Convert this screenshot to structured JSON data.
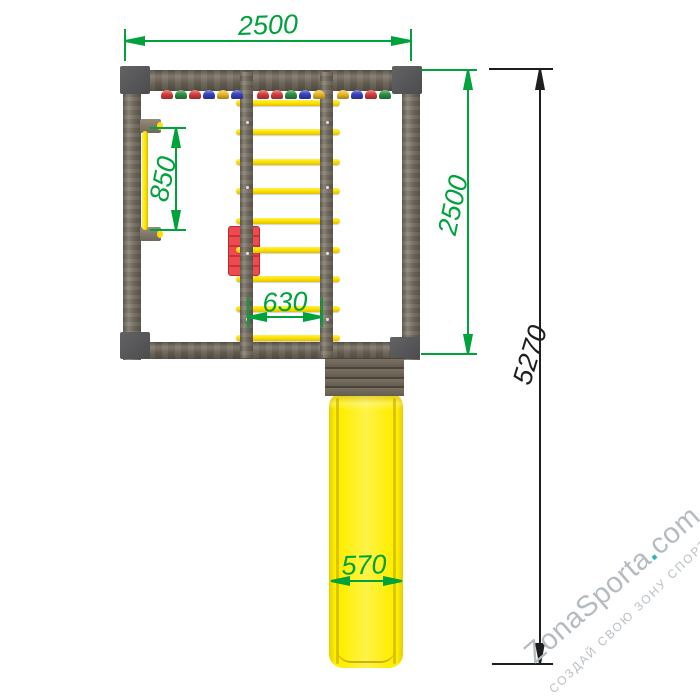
{
  "drawing": {
    "title_semantics": "playground-top-view-drawing",
    "dimensions": {
      "top_width": "2500",
      "right_height": "2500",
      "grab_bar_length": "850",
      "ladder_span": "630",
      "slide_width": "570",
      "total_length": "5270"
    },
    "colors": {
      "dimension_green": "#00a23c",
      "dimension_black": "#1e1e20",
      "wood_beam": "#7b7365",
      "corner_gray": "#58585b",
      "rung_yellow": "#ffe400",
      "slide_yellow": "#ffee00",
      "red_panel": "#e04045",
      "watermark_gray": "#b5bcc1",
      "watermark_teal": "#31b7ae"
    },
    "structure": {
      "rung_count": 9,
      "plank_count": 4,
      "holds_groups": [
        [
          "red",
          "green",
          "red",
          "blue",
          "yellow",
          "blue"
        ],
        [
          "red",
          "red",
          "green",
          "blue",
          "yellow"
        ],
        [
          "yellow",
          "blue",
          "red",
          "green"
        ]
      ],
      "hold_colors": {
        "red": "#d93c3c",
        "green": "#2d9143",
        "blue": "#3843c0",
        "yellow": "#ecb924"
      },
      "beam_bolt_fractions": [
        0.17,
        0.4,
        0.63,
        0.86
      ]
    },
    "watermark": {
      "brand": "ZonaSporta",
      "dot": ".",
      "tld": "com",
      "tagline": "СОЗДАЙ СВОЮ ЗОНУ СПОРТА"
    }
  }
}
